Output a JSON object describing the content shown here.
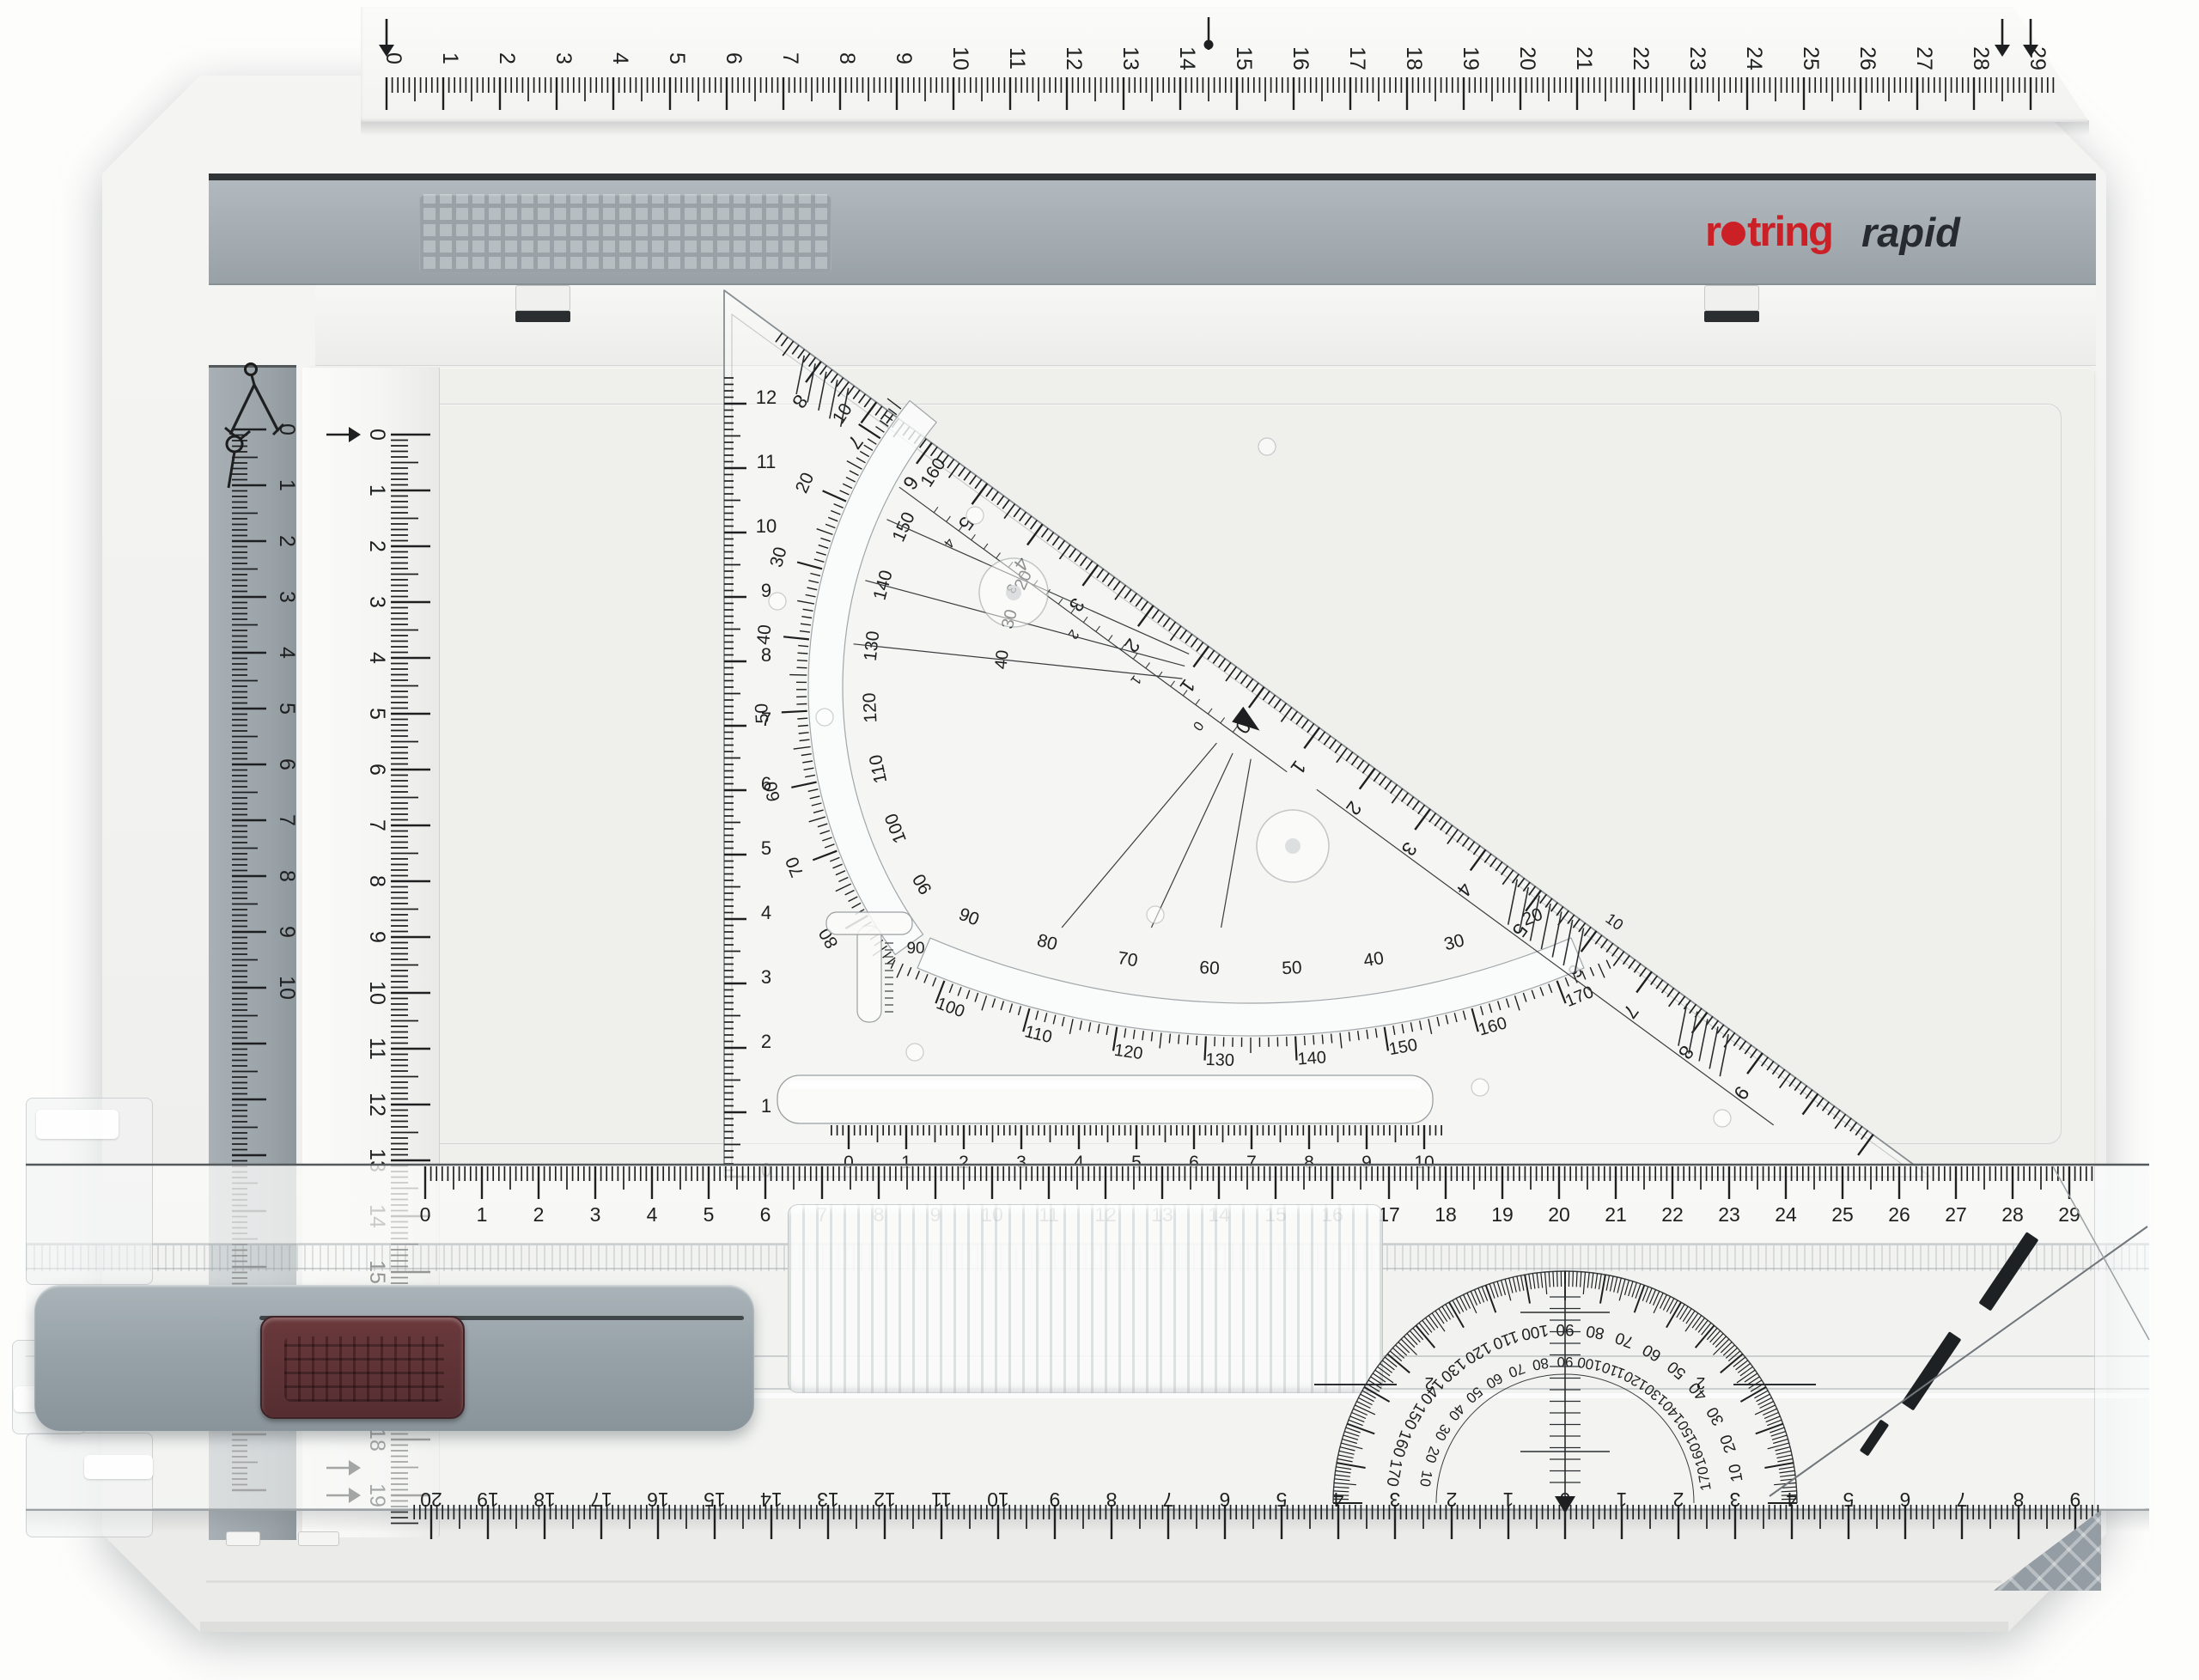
{
  "product": {
    "brand_r": "r",
    "brand_rest": "tring",
    "model": "rapid"
  },
  "board": {
    "top_ruler": {
      "labels": [
        "0",
        "1",
        "2",
        "3",
        "4",
        "5",
        "6",
        "7",
        "8",
        "9",
        "10",
        "11",
        "12",
        "13",
        "14",
        "15",
        "16",
        "17",
        "18",
        "19",
        "20",
        "21",
        "22",
        "23",
        "24",
        "25",
        "26",
        "27",
        "28",
        "29"
      ]
    },
    "left_gray_ruler": {
      "icon": "compass-icon",
      "labels": [
        "0",
        "1",
        "2",
        "3",
        "4",
        "5",
        "6",
        "7",
        "8",
        "9",
        "10"
      ]
    },
    "left_white_ruler": {
      "labels": [
        "0",
        "1",
        "2",
        "3",
        "4",
        "5",
        "6",
        "7",
        "8",
        "9",
        "10",
        "11",
        "12",
        "13",
        "14",
        "15",
        "16",
        "17",
        "18",
        "19"
      ]
    }
  },
  "rail": {
    "top_ruler": {
      "labels": [
        "0",
        "1",
        "2",
        "3",
        "4",
        "5",
        "6",
        "7",
        "8",
        "9",
        "10",
        "11",
        "12",
        "13",
        "14",
        "15",
        "16",
        "17",
        "18",
        "19",
        "20",
        "21",
        "22",
        "23",
        "24",
        "25",
        "26",
        "27",
        "28",
        "29"
      ]
    },
    "bottom_ruler": {
      "labels": [
        "20",
        "19",
        "18",
        "17",
        "16",
        "15",
        "14",
        "13",
        "12",
        "11",
        "10",
        "9",
        "8",
        "7",
        "6",
        "5",
        "4",
        "3",
        "2",
        "1",
        "0",
        "1",
        "2",
        "3",
        "4",
        "5",
        "6",
        "7",
        "8",
        "9"
      ]
    },
    "protractor": {
      "outer_labels": [
        "170",
        "160",
        "150",
        "140",
        "130",
        "120",
        "110",
        "100",
        "90",
        "80",
        "70",
        "60",
        "50",
        "40",
        "30",
        "20",
        "10"
      ],
      "inner_labels": [
        "10",
        "20",
        "30",
        "40",
        "50",
        "60",
        "70",
        "80",
        "90",
        "100",
        "110",
        "120",
        "130",
        "140",
        "150",
        "160",
        "170"
      ],
      "crosshair_left": "2",
      "crosshair_right": "2"
    }
  },
  "triangle": {
    "hyp_ruler": {
      "labels": [
        "8",
        "7",
        "6",
        "5",
        "4",
        "3",
        "2",
        "1",
        "0",
        "1",
        "2",
        "3",
        "4",
        "5",
        "6",
        "7",
        "8",
        "9"
      ]
    },
    "left_ruler": {
      "labels": [
        "12",
        "11",
        "10",
        "9",
        "8",
        "7",
        "6",
        "5",
        "4",
        "3",
        "2",
        "1",
        "0"
      ]
    },
    "bottom_ruler": {
      "labels": [
        "0",
        "1",
        "2",
        "3",
        "4",
        "5",
        "6",
        "7",
        "8",
        "9",
        "10"
      ]
    },
    "upper_arc": {
      "outer_labels": [
        "10",
        "20",
        "30",
        "40",
        "50",
        "60",
        "70",
        "80"
      ],
      "inner_labels": [
        "160",
        "150",
        "140",
        "130",
        "120",
        "110",
        "100",
        "90"
      ]
    },
    "lower_arc": {
      "inner_labels": [
        "90",
        "80",
        "70",
        "60",
        "50",
        "40",
        "30",
        "20"
      ],
      "outer_labels": [
        "100",
        "110",
        "120",
        "130",
        "140",
        "150",
        "160",
        "170"
      ]
    },
    "radial_labels": [
      "20",
      "30",
      "40"
    ],
    "mini_scale_labels": [
      "4",
      "3",
      "2",
      "1",
      "0"
    ],
    "tmark_label": "90",
    "hyp_small_label": "10"
  },
  "colors": {
    "brand_red": "#cb2026",
    "logo_dark": "#272b30",
    "bar_gray": "#a7afb4",
    "tick": "#1e1f20",
    "board": "#f2f2f0",
    "button_maroon": "#5d3134"
  }
}
